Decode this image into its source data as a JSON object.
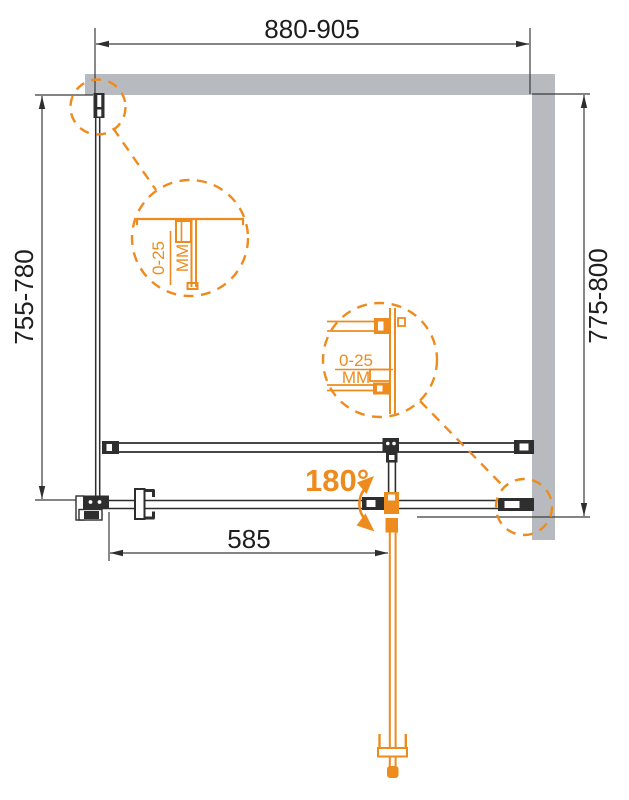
{
  "colors": {
    "accent_orange": "#ee8b1e",
    "wall_gray": "#b7bbc0",
    "line_black": "#2e2e2e",
    "dimension_text": "#1e1e1e",
    "background": "#ffffff"
  },
  "dimensions": {
    "top_width": "880-905",
    "left_height": "755-780",
    "right_height": "775-800",
    "door_width": "585",
    "swing_angle": "180°"
  },
  "details": {
    "left_profile": {
      "range": "0-25",
      "unit": "MM"
    },
    "right_profile": {
      "range": "0-25",
      "unit": "MM"
    }
  }
}
